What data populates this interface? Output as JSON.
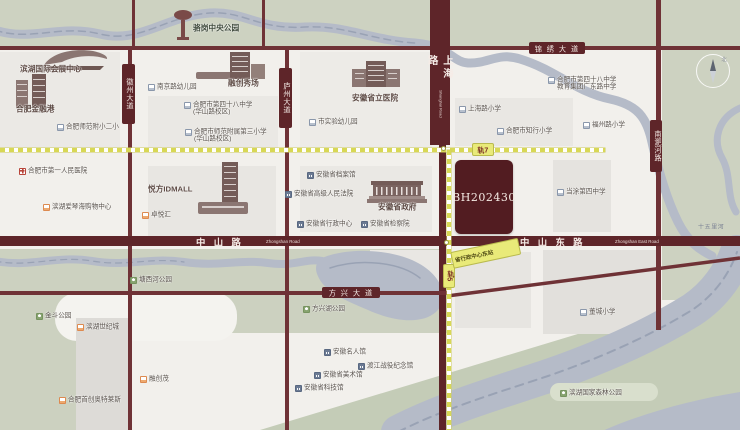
{
  "map": {
    "parcel": {
      "label": "BH202430"
    },
    "compass": {
      "label": "北"
    },
    "river_label": "十五里河",
    "roads": {
      "jinxiu": {
        "label": "锦 绣 大 道"
      },
      "zhongshan": {
        "label": "中 山 路",
        "en": "Zhongshan Road"
      },
      "zhongshan_east": {
        "label": "中 山 东 路",
        "en": "Zhongshan East Road"
      },
      "fangxing": {
        "label": "方 兴 大 道"
      },
      "huizhou": {
        "label": "徽州大道"
      },
      "luzhou": {
        "label": "庐州大道"
      },
      "shanghai": {
        "label": "上海路",
        "en": "Shanghai Road"
      },
      "nanfeihe": {
        "label": "南淝河路"
      }
    },
    "metro": {
      "line7_badge": "轨7",
      "line5_badge": "轨5",
      "station": "省行政中心东站"
    },
    "pois": [
      {
        "id": "luogang-central-park",
        "type": "plain-green",
        "x": 193,
        "y": 25,
        "lines": [
          "骆岗中央公园"
        ]
      },
      {
        "id": "binhu-convention-center",
        "type": "plain",
        "x": 20,
        "y": 66,
        "lines": [
          "滨湖国际会展中心"
        ]
      },
      {
        "id": "hefei-financial-harbor",
        "type": "plain",
        "x": 16,
        "y": 106,
        "lines": [
          "合肥金融港"
        ]
      },
      {
        "id": "shifan-fuxiao-no2",
        "type": "school",
        "x": 57,
        "y": 123,
        "lines": [
          "合肥师范附小二小"
        ]
      },
      {
        "id": "nanjing-rd-kindergarten",
        "type": "school",
        "x": 148,
        "y": 83,
        "lines": [
          "南京路幼儿园"
        ]
      },
      {
        "id": "no48-middle-huashan",
        "type": "school",
        "x": 184,
        "y": 101,
        "lines": [
          "合肥市第四十八中学",
          "(华山路校区)"
        ]
      },
      {
        "id": "shifan-no3-primary",
        "type": "school",
        "x": 185,
        "y": 128,
        "lines": [
          "合肥市师范附属第三小学",
          "(华山路校区)"
        ]
      },
      {
        "id": "rongchuang-showplace",
        "type": "plain",
        "x": 228,
        "y": 80,
        "lines": [
          "融创秀场"
        ]
      },
      {
        "id": "anhui-provincial-hospital",
        "type": "plain",
        "x": 352,
        "y": 95,
        "lines": [
          "安徽省立医院"
        ]
      },
      {
        "id": "shiyan-kindergarten",
        "type": "school",
        "x": 309,
        "y": 118,
        "lines": [
          "市实验幼儿园"
        ]
      },
      {
        "id": "shanghai-rd-primary",
        "type": "school",
        "x": 459,
        "y": 105,
        "lines": [
          "上海路小学"
        ]
      },
      {
        "id": "no48-middle-guangdong",
        "type": "school",
        "x": 548,
        "y": 76,
        "lines": [
          "合肥市第四十八中学",
          "教育集团广东路中学"
        ]
      },
      {
        "id": "zhixing-primary",
        "type": "school",
        "x": 497,
        "y": 127,
        "lines": [
          "合肥市知行小学"
        ]
      },
      {
        "id": "fuzhou-rd-primary",
        "type": "school",
        "x": 583,
        "y": 121,
        "lines": [
          "福州路小学"
        ]
      },
      {
        "id": "first-peoples-hospital",
        "type": "hospital",
        "x": 19,
        "y": 167,
        "lines": [
          "合肥市第一人民医院"
        ]
      },
      {
        "id": "aiqinhai-mall",
        "type": "mall",
        "x": 43,
        "y": 203,
        "lines": [
          "滨湖爱琴海购物中心"
        ]
      },
      {
        "id": "idmall",
        "type": "plain",
        "x": 148,
        "y": 186,
        "lines": [
          "悦方IDMALL"
        ]
      },
      {
        "id": "zhuoyuehui",
        "type": "mall",
        "x": 142,
        "y": 211,
        "lines": [
          "卓悦汇"
        ]
      },
      {
        "id": "provincial-archives",
        "type": "gov",
        "x": 307,
        "y": 171,
        "lines": [
          "安徽省档案馆"
        ]
      },
      {
        "id": "provincial-high-court",
        "type": "gov",
        "x": 285,
        "y": 190,
        "lines": [
          "安徽省高级人民法院"
        ]
      },
      {
        "id": "provincial-government",
        "type": "plain",
        "x": 378,
        "y": 204,
        "lines": [
          "安徽省政府"
        ]
      },
      {
        "id": "provincial-admin-center",
        "type": "gov",
        "x": 297,
        "y": 220,
        "lines": [
          "安徽省行政中心"
        ]
      },
      {
        "id": "provincial-procuratorate",
        "type": "gov",
        "x": 361,
        "y": 220,
        "lines": [
          "安徽省检察院"
        ]
      },
      {
        "id": "dangtu-no4-middle",
        "type": "school",
        "x": 557,
        "y": 188,
        "lines": [
          "当涂第四中学"
        ]
      },
      {
        "id": "dongcheng-primary",
        "type": "school",
        "x": 580,
        "y": 308,
        "lines": [
          "董城小学"
        ]
      },
      {
        "id": "jindou-park",
        "type": "park",
        "x": 36,
        "y": 312,
        "lines": [
          "金斗公园"
        ]
      },
      {
        "id": "binhu-century-city",
        "type": "mall",
        "x": 77,
        "y": 323,
        "lines": [
          "滨湖世纪城"
        ]
      },
      {
        "id": "tangxihe-park",
        "type": "park",
        "x": 130,
        "y": 276,
        "lines": [
          "塘西河公园"
        ]
      },
      {
        "id": "rongchuang-mao",
        "type": "mall",
        "x": 140,
        "y": 375,
        "lines": [
          "融创茂"
        ]
      },
      {
        "id": "shouchuang-outlets",
        "type": "mall",
        "x": 59,
        "y": 396,
        "lines": [
          "合肥首创奥特莱斯"
        ]
      },
      {
        "id": "fangxinghu-park",
        "type": "park",
        "x": 303,
        "y": 305,
        "lines": [
          "方兴湖公园"
        ]
      },
      {
        "id": "anhui-celebrities-museum",
        "type": "gov",
        "x": 324,
        "y": 348,
        "lines": [
          "安徽名人馆"
        ]
      },
      {
        "id": "dujiang-campaign-memorial",
        "type": "gov",
        "x": 358,
        "y": 362,
        "lines": [
          "渡江战役纪念馆"
        ]
      },
      {
        "id": "anhui-art-museum",
        "type": "gov",
        "x": 314,
        "y": 371,
        "lines": [
          "安徽省美术馆"
        ]
      },
      {
        "id": "anhui-sci-tech-museum",
        "type": "gov",
        "x": 295,
        "y": 384,
        "lines": [
          "安徽省科技馆"
        ]
      },
      {
        "id": "binhu-forest-park",
        "type": "park",
        "x": 560,
        "y": 389,
        "lines": [
          "滨湖国家森林公园"
        ]
      }
    ]
  }
}
